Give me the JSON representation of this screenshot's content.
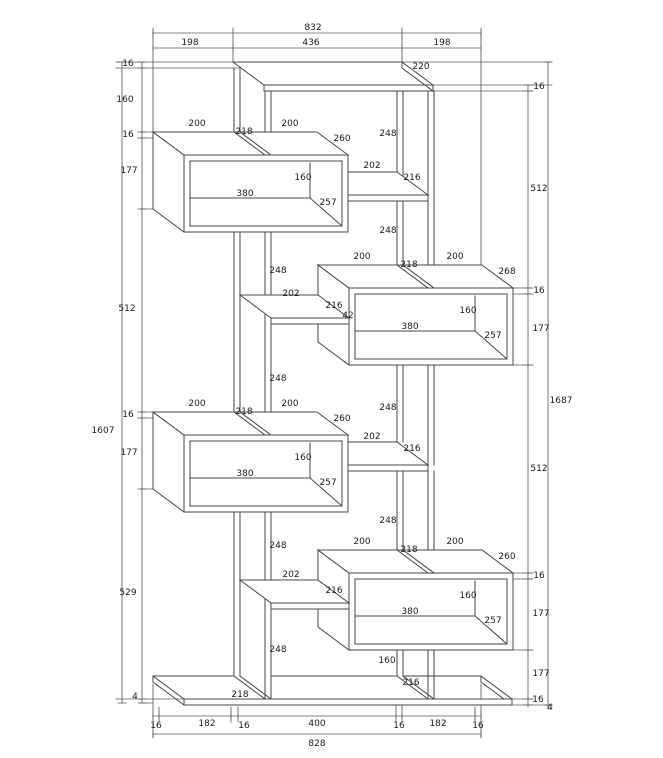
{
  "colors": {
    "line": "#474747",
    "dim_line": "#5c5c5c",
    "label": "#1b1b1b",
    "background": "#ffffff"
  },
  "drawing": {
    "labels": [
      {
        "name": "dim-top-overall",
        "text": "832",
        "x": 313,
        "y": 30
      },
      {
        "name": "dim-top-left-198",
        "text": "198",
        "x": 190,
        "y": 45
      },
      {
        "name": "dim-top-center-436",
        "text": "436",
        "x": 311,
        "y": 45
      },
      {
        "name": "dim-top-right-198",
        "text": "198",
        "x": 442,
        "y": 45
      },
      {
        "name": "dim-top-depth-220",
        "text": "220",
        "x": 421,
        "y": 69
      },
      {
        "name": "dim-left-16-1",
        "text": "16",
        "x": 128,
        "y": 66
      },
      {
        "name": "dim-left-160",
        "text": "160",
        "x": 125,
        "y": 102
      },
      {
        "name": "dim-left-16-2",
        "text": "16",
        "x": 128,
        "y": 137
      },
      {
        "name": "dim-left-177-1",
        "text": "177",
        "x": 129,
        "y": 173
      },
      {
        "name": "dim-left-512",
        "text": "512",
        "x": 127,
        "y": 311
      },
      {
        "name": "dim-left-16-3",
        "text": "16",
        "x": 128,
        "y": 417
      },
      {
        "name": "dim-left-177-2",
        "text": "177",
        "x": 129,
        "y": 455
      },
      {
        "name": "dim-left-529",
        "text": "529",
        "x": 128,
        "y": 595
      },
      {
        "name": "dim-left-4",
        "text": "4",
        "x": 135,
        "y": 699
      },
      {
        "name": "dim-left-total-1607",
        "text": "1607",
        "x": 103,
        "y": 433
      },
      {
        "name": "dim-right-16-1",
        "text": "16",
        "x": 539,
        "y": 89
      },
      {
        "name": "dim-right-512-1",
        "text": "512",
        "x": 539,
        "y": 191
      },
      {
        "name": "dim-right-16-2",
        "text": "16",
        "x": 539,
        "y": 293
      },
      {
        "name": "dim-right-177-1",
        "text": "177",
        "x": 541,
        "y": 331
      },
      {
        "name": "dim-right-512-2",
        "text": "512",
        "x": 539,
        "y": 471
      },
      {
        "name": "dim-right-16-3",
        "text": "16",
        "x": 539,
        "y": 578
      },
      {
        "name": "dim-right-177-2",
        "text": "177",
        "x": 541,
        "y": 616
      },
      {
        "name": "dim-right-177-3",
        "text": "177",
        "x": 541,
        "y": 676
      },
      {
        "name": "dim-right-16-4",
        "text": "16",
        "x": 538,
        "y": 702
      },
      {
        "name": "dim-right-4",
        "text": "4",
        "x": 550,
        "y": 710
      },
      {
        "name": "dim-right-total-1687",
        "text": "1687",
        "x": 561,
        "y": 403
      },
      {
        "name": "dim-bottom-16-1",
        "text": "16",
        "x": 156,
        "y": 728
      },
      {
        "name": "dim-bottom-182-1",
        "text": "182",
        "x": 207,
        "y": 726
      },
      {
        "name": "dim-bottom-16-2",
        "text": "16",
        "x": 244,
        "y": 728
      },
      {
        "name": "dim-bottom-400",
        "text": "400",
        "x": 317,
        "y": 726
      },
      {
        "name": "dim-bottom-16-3",
        "text": "16",
        "x": 399,
        "y": 728
      },
      {
        "name": "dim-bottom-182-2",
        "text": "182",
        "x": 438,
        "y": 726
      },
      {
        "name": "dim-bottom-16-4",
        "text": "16",
        "x": 478,
        "y": 728
      },
      {
        "name": "dim-bottom-total-828",
        "text": "828",
        "x": 317,
        "y": 746
      },
      {
        "name": "box1-top-left-200",
        "text": "200",
        "x": 197,
        "y": 126
      },
      {
        "name": "box1-spine-218",
        "text": "218",
        "x": 244,
        "y": 134
      },
      {
        "name": "box1-top-right-200",
        "text": "200",
        "x": 290,
        "y": 126
      },
      {
        "name": "box1-depth-260",
        "text": "260",
        "x": 342,
        "y": 141
      },
      {
        "name": "box1-inner-height-160",
        "text": "160",
        "x": 303,
        "y": 180
      },
      {
        "name": "box1-inner-width-380",
        "text": "380",
        "x": 245,
        "y": 196
      },
      {
        "name": "box1-floor-diag-257",
        "text": "257",
        "x": 328,
        "y": 205
      },
      {
        "name": "box2-top-left-200",
        "text": "200",
        "x": 362,
        "y": 259
      },
      {
        "name": "box2-spine-218",
        "text": "218",
        "x": 409,
        "y": 267
      },
      {
        "name": "box2-top-right-200",
        "text": "200",
        "x": 455,
        "y": 259
      },
      {
        "name": "box2-depth-268",
        "text": "268",
        "x": 507,
        "y": 274
      },
      {
        "name": "box2-inner-height-160",
        "text": "160",
        "x": 468,
        "y": 313
      },
      {
        "name": "box2-inner-width-380",
        "text": "380",
        "x": 410,
        "y": 329
      },
      {
        "name": "box2-floor-diag-257",
        "text": "257",
        "x": 493,
        "y": 338
      },
      {
        "name": "box2-shelf-216",
        "text": "216",
        "x": 334,
        "y": 308
      },
      {
        "name": "box2-shelf-42",
        "text": "42",
        "x": 348,
        "y": 318
      },
      {
        "name": "box3-top-left-200",
        "text": "200",
        "x": 197,
        "y": 406
      },
      {
        "name": "box3-spine-218",
        "text": "218",
        "x": 244,
        "y": 414
      },
      {
        "name": "box3-top-right-200",
        "text": "200",
        "x": 290,
        "y": 406
      },
      {
        "name": "box3-depth-260",
        "text": "260",
        "x": 342,
        "y": 421
      },
      {
        "name": "box3-inner-height-160",
        "text": "160",
        "x": 303,
        "y": 460
      },
      {
        "name": "box3-inner-width-380",
        "text": "380",
        "x": 245,
        "y": 476
      },
      {
        "name": "box3-floor-diag-257",
        "text": "257",
        "x": 328,
        "y": 485
      },
      {
        "name": "box4-top-left-200",
        "text": "200",
        "x": 362,
        "y": 544
      },
      {
        "name": "box4-spine-218",
        "text": "218",
        "x": 409,
        "y": 552
      },
      {
        "name": "box4-top-right-200",
        "text": "200",
        "x": 455,
        "y": 544
      },
      {
        "name": "box4-depth-260",
        "text": "260",
        "x": 507,
        "y": 559
      },
      {
        "name": "box4-inner-height-160",
        "text": "160",
        "x": 468,
        "y": 598
      },
      {
        "name": "box4-inner-width-380",
        "text": "380",
        "x": 410,
        "y": 614
      },
      {
        "name": "box4-floor-diag-257",
        "text": "257",
        "x": 493,
        "y": 623
      },
      {
        "name": "box4-shelf-216",
        "text": "216",
        "x": 334,
        "y": 593
      },
      {
        "name": "shelf-r1-202",
        "text": "202",
        "x": 372,
        "y": 168
      },
      {
        "name": "shelf-r1-216",
        "text": "216",
        "x": 412,
        "y": 180
      },
      {
        "name": "shelf-r2-202",
        "text": "202",
        "x": 372,
        "y": 439
      },
      {
        "name": "shelf-r2-216",
        "text": "216",
        "x": 412,
        "y": 451
      },
      {
        "name": "shelf-l1-202",
        "text": "202",
        "x": 291,
        "y": 296
      },
      {
        "name": "shelf-l2-202",
        "text": "202",
        "x": 291,
        "y": 577
      },
      {
        "name": "gap-248-1",
        "text": "248",
        "x": 388,
        "y": 136
      },
      {
        "name": "gap-248-2",
        "text": "248",
        "x": 388,
        "y": 233
      },
      {
        "name": "gap-248-3",
        "text": "248",
        "x": 278,
        "y": 273
      },
      {
        "name": "gap-248-4",
        "text": "248",
        "x": 278,
        "y": 381
      },
      {
        "name": "gap-248-5",
        "text": "248",
        "x": 388,
        "y": 410
      },
      {
        "name": "gap-248-6",
        "text": "248",
        "x": 388,
        "y": 523
      },
      {
        "name": "gap-248-7",
        "text": "248",
        "x": 278,
        "y": 548
      },
      {
        "name": "gap-248-8",
        "text": "248",
        "x": 278,
        "y": 652
      },
      {
        "name": "bottom-box-218",
        "text": "218",
        "x": 240,
        "y": 697
      },
      {
        "name": "bottom-box-160",
        "text": "160",
        "x": 387,
        "y": 663
      },
      {
        "name": "bottom-box-216",
        "text": "216",
        "x": 411,
        "y": 685
      }
    ]
  }
}
